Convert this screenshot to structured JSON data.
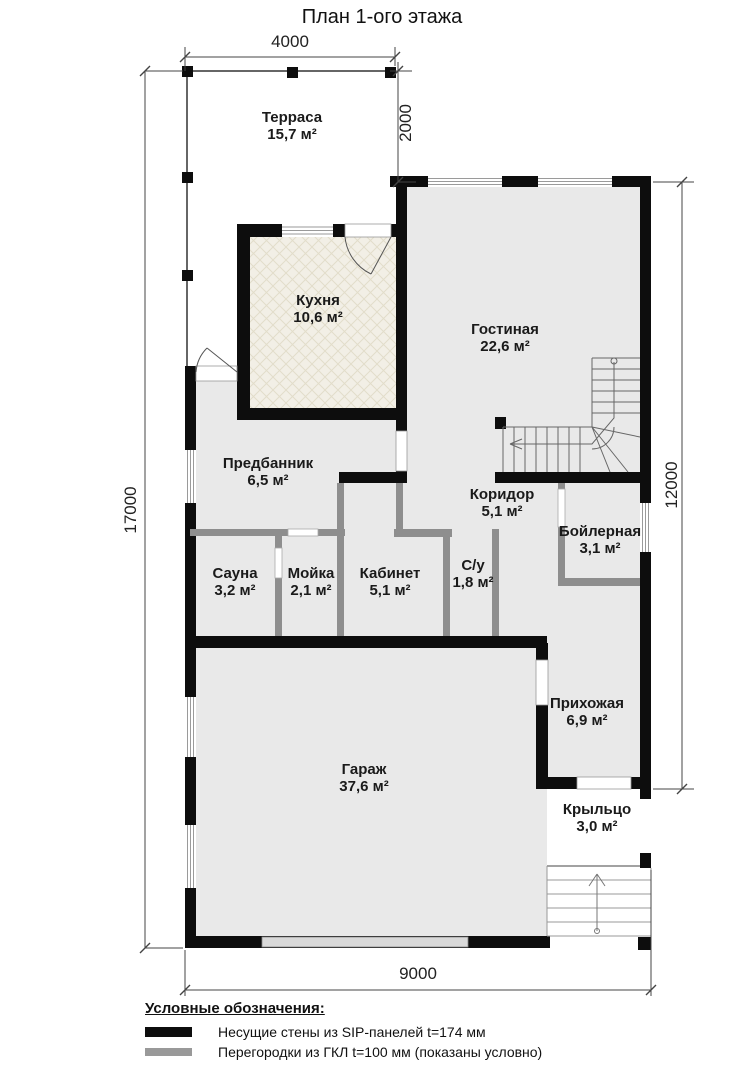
{
  "title": "План 1-ого этажа",
  "rooms": [
    {
      "name": "Терраса",
      "area": "15,7 м²"
    },
    {
      "name": "Кухня",
      "area": "10,6 м²"
    },
    {
      "name": "Гостиная",
      "area": "22,6 м²"
    },
    {
      "name": "Предбанник",
      "area": "6,5 м²"
    },
    {
      "name": "Сауна",
      "area": "3,2 м²"
    },
    {
      "name": "Мойка",
      "area": "2,1 м²"
    },
    {
      "name": "Кабинет",
      "area": "5,1 м²"
    },
    {
      "name": "Коридор",
      "area": "5,1 м²"
    },
    {
      "name": "С/у",
      "area": "1,8 м²"
    },
    {
      "name": "Бойлерная",
      "area": "3,1 м²"
    },
    {
      "name": "Прихожая",
      "area": "6,9 м²"
    },
    {
      "name": "Гараж",
      "area": "37,6 м²"
    },
    {
      "name": "Крыльцо",
      "area": "3,0 м²"
    }
  ],
  "dimensions": {
    "top": "4000",
    "terrace_depth": "2000",
    "left": "17000",
    "right": "12000",
    "bottom": "9000"
  },
  "legend": {
    "heading": "Условные обозначения:",
    "items": [
      {
        "swatch_color": "#0d0d0d",
        "label": "Несущие стены из SIP-панелей t=174 мм"
      },
      {
        "swatch_color": "#999999",
        "label": "Перегородки из ГКЛ t=100 мм (показаны условно)"
      }
    ]
  },
  "colors": {
    "bearing_wall": "#0d0d0d",
    "partition": "#8e8e8e",
    "room_fill": "#e9e9e9",
    "kitchen_fill": "#f2efe6",
    "line": "#555555"
  }
}
